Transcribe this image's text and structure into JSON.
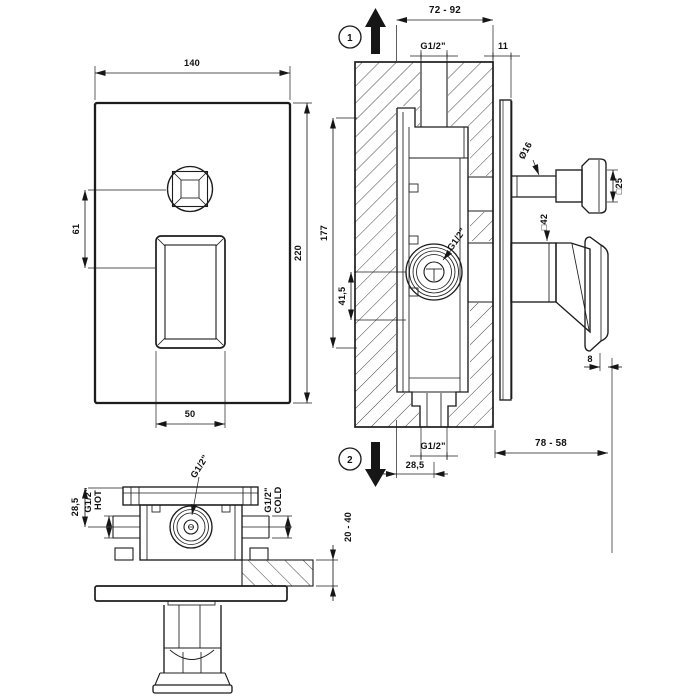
{
  "drawing": {
    "front_view": {
      "plate_width": "140",
      "plate_height": "220",
      "button_to_lever_offset": "61",
      "lever_width": "50"
    },
    "section_view": {
      "step_marker_top": "1",
      "step_marker_bottom": "2",
      "rough_wall_depth_range": "72 - 92",
      "inlet_thread": "G1/2\"",
      "plate_clearance": "11",
      "body_height": "177",
      "port_to_outlet": "41,5",
      "port_thread": "G1/2\"",
      "button_stem_diameter": "Ø16",
      "button_knob_square": "□25",
      "lever_base_square": "□42",
      "grip_thickness": "8",
      "protrusion_range": "78 - 58",
      "outlet_thread": "G1/2\"",
      "outlet_offset": "28,5"
    },
    "plan_view": {
      "flange_to_pipe_axis": "28,5",
      "hot_inlet_thread": "G1/2\"",
      "hot_inlet_label": "HOT",
      "outlet_thread": "G1/2\"",
      "cold_inlet_thread": "G1/2\"",
      "cold_inlet_label": "COLD",
      "finished_wall_range": "20 - 40"
    }
  }
}
